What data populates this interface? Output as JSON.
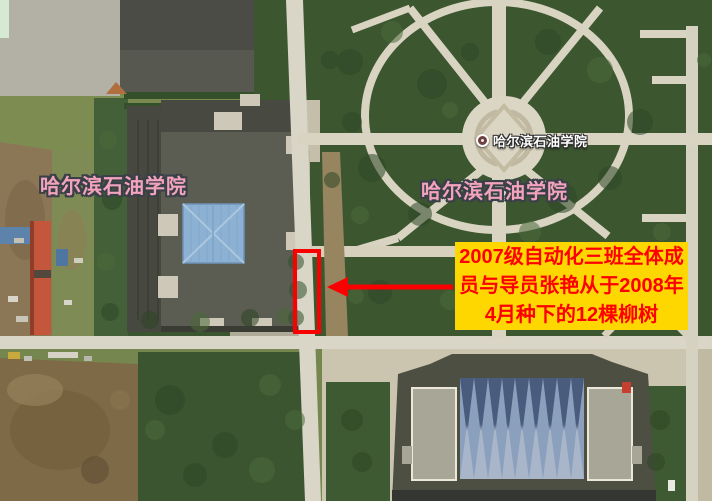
{
  "map": {
    "poi_marker": {
      "label": "哈尔滨石油学院"
    },
    "labels": {
      "campus_left": "哈尔滨石油学院",
      "campus_center": "哈尔滨石油学院"
    },
    "annotation": {
      "lines": [
        "2007级自动化三班全体成",
        "员与导员张艳从于2008年",
        "4月种下的12棵柳树"
      ]
    },
    "colors": {
      "annotation_bg": "#FFD700",
      "annotation_text": "#FF0000",
      "highlight_red": "#FA0000",
      "campus_label_pink": "#F3A3BB",
      "poi_text": "#FFFFFF"
    }
  }
}
